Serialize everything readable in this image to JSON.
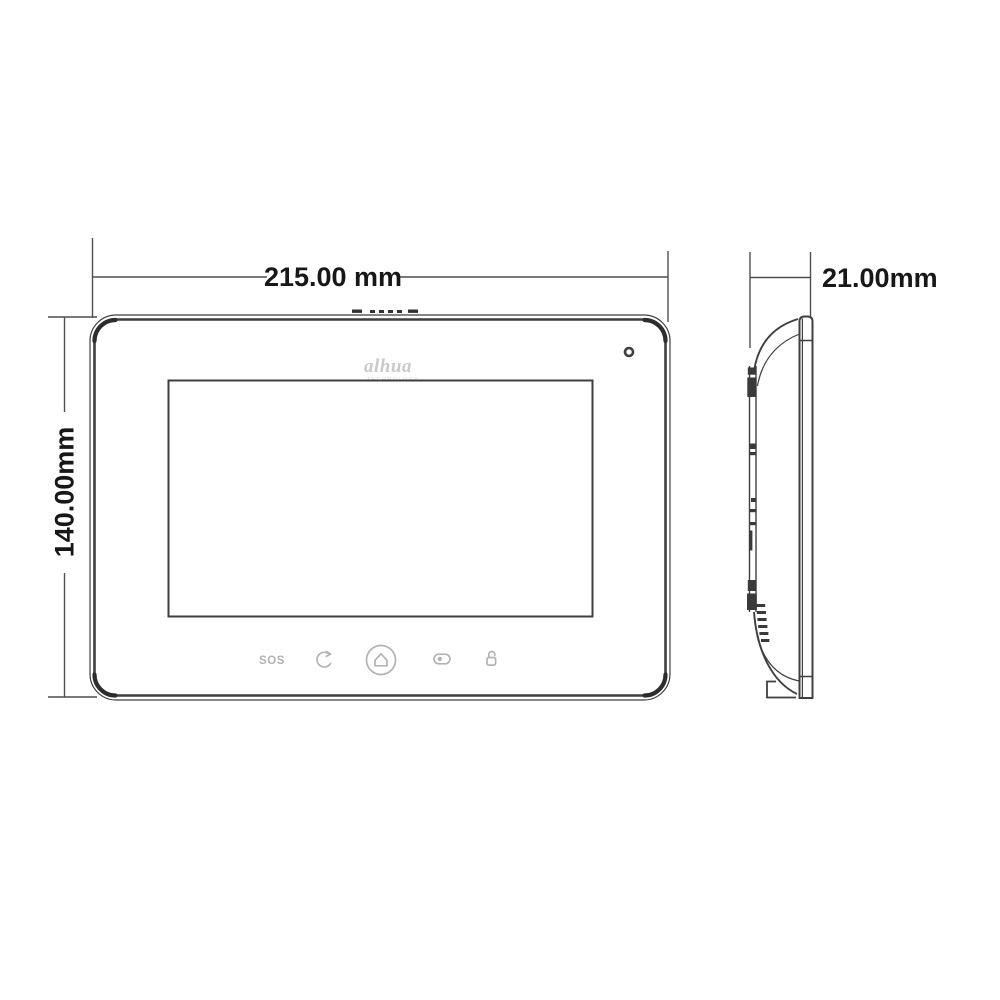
{
  "colors": {
    "background": "#ffffff",
    "outline": "#3f3f3f",
    "dimension_line": "#4f4f4f",
    "dimension_text": "#171717",
    "button_gray": "#b3b3b3",
    "logo_gray": "#c9c9c9",
    "logo_sub_gray": "#d6d6d6"
  },
  "dimensions": {
    "width_label": "215.00 mm",
    "height_label": "140.00mm",
    "depth_label": "21.00mm"
  },
  "front_view": {
    "logo_text": "alhua",
    "logo_subtext": "TECHNOLOGY",
    "features": [
      "speaker-grille",
      "microphone-hole",
      "screen"
    ],
    "buttons": [
      {
        "id": "sos-button",
        "type": "text",
        "label": "SOS"
      },
      {
        "id": "call-button",
        "type": "icon",
        "icon": "call-icon"
      },
      {
        "id": "home-button",
        "type": "icon",
        "icon": "home-icon"
      },
      {
        "id": "monitor-button",
        "type": "icon",
        "icon": "monitor-icon"
      },
      {
        "id": "unlock-button",
        "type": "icon",
        "icon": "unlock-icon"
      }
    ]
  },
  "side_view": {
    "features": [
      "front-panel",
      "mounting-rail",
      "mounting-brackets",
      "vent-slots",
      "bottom-foot"
    ]
  }
}
